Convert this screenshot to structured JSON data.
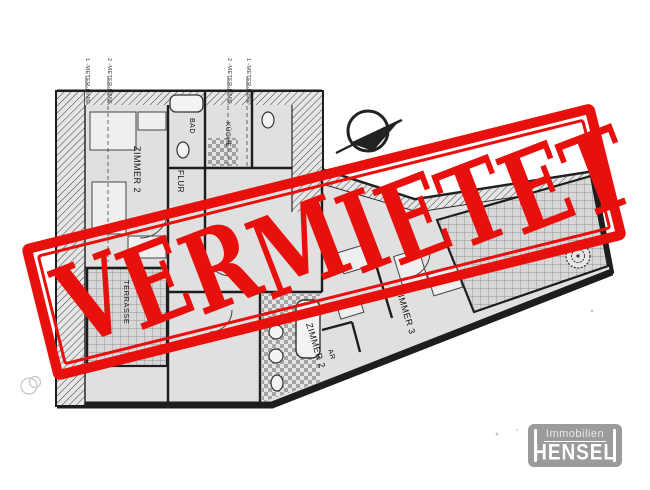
{
  "stamp": {
    "text": "VERMIETET",
    "color": "#e8100c"
  },
  "floor_plan": {
    "ink_color": "#222222",
    "room_fill": "#e0e0e0",
    "meter_line_labels": [
      "1 -METER-LINIE",
      "2 -METER-LINIE",
      "2 -METER-LINIE",
      "1 -METER-LINIE"
    ],
    "room_labels": {
      "zimmer2_upper": "ZIMMER 2",
      "flur": "FLUR",
      "bad": "BAD",
      "kueche": "KÜCHE",
      "terrasse": "TERRASSE",
      "zimmer2_lower": "ZIMMER 2",
      "zimmer3": "ZIMMER 3",
      "abstellraum": "AR"
    },
    "icons": {
      "north_arrow": "north-arrow-icon",
      "flower": "terrace-plant-icon"
    }
  },
  "logo": {
    "line1": "Immobilien",
    "line2": "HENSEL",
    "bg_color": "#9b9b9b",
    "text_color": "#ffffff"
  }
}
